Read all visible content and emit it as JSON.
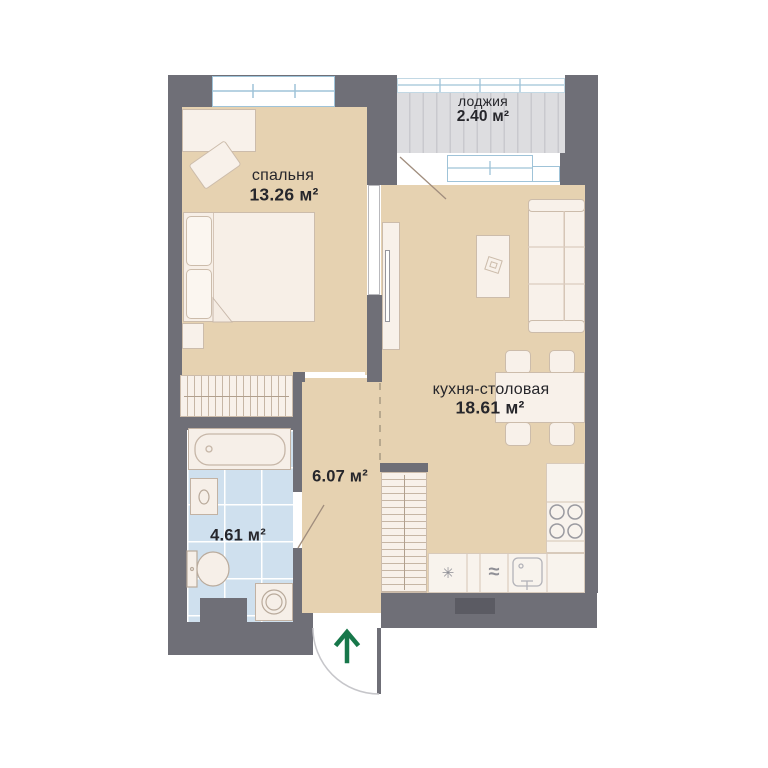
{
  "rooms": {
    "bedroom": {
      "name": "спальня",
      "area": "13.26 м²"
    },
    "loggia": {
      "name": "лоджия",
      "area": "2.40 м²"
    },
    "kitchen_dining": {
      "name": "кухня-столовая",
      "area": "18.61 м²"
    },
    "hallway": {
      "area": "6.07 м²"
    },
    "bathroom": {
      "area": "4.61 м²"
    }
  },
  "icons": {
    "fridge_snowflake": "✳",
    "dishwasher_waves": "≈"
  },
  "colors": {
    "walls": "#6f6f77",
    "vent_shaft": "#5b5b63",
    "floor_beige": "#e6d2b1",
    "bathroom_tile": "#cfe0ee",
    "loggia_gray": "#dcdcde",
    "window_frame_blue": "#9fc3d8",
    "entry_arrow_green": "#17774a",
    "label_text": "#26262b"
  },
  "entrance_arrow_direction": "up"
}
